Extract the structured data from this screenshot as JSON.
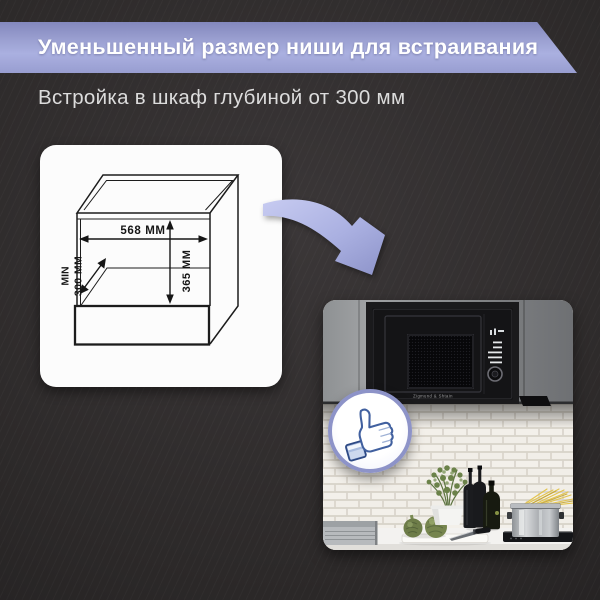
{
  "banner": {
    "title": "Уменьшенный размер ниши для встраивания"
  },
  "subtitle": {
    "text": "Встройка в шкаф глубиной от 300 мм"
  },
  "diagram": {
    "width_label": "568 ММ",
    "height_label": "365 ММ",
    "depth_min_label": "MIN",
    "depth_value_label": "300 ММ"
  },
  "photo": {
    "microwave_brand": "Zigmund & Shtain"
  },
  "icons": {
    "arrow": "curved-arrow-icon",
    "badge": "thumbs-up-icon"
  },
  "colors": {
    "background": "#2e2b2c",
    "banner_top": "#8388bd",
    "banner_bottom": "#aab0e0",
    "accent_ring": "#8d93c8",
    "card": "#fcfcfc",
    "subtitle_text": "#dcdcdc",
    "drawing_lines": "#161616"
  }
}
